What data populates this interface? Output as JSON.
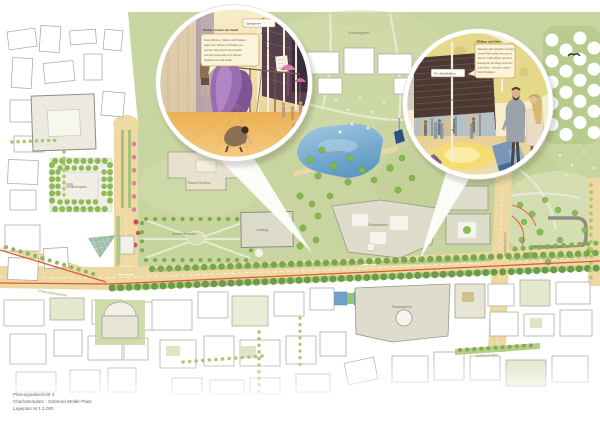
{
  "page": {
    "background": "#ffffff"
  },
  "title_block": {
    "line1": "Planungsabschnitt 4",
    "line2": "Charlottenplatz - Gebhard-Müller-Platz",
    "line3": "Lageplan M 1:1.000"
  },
  "map": {
    "palette": {
      "park_green": "#c8d5a0",
      "lawn_light": "#d8e0b8",
      "road_tan": "#ecd8a0",
      "water_blue": "#6fa3cc",
      "tram_red": "#dd5a3a",
      "tree_green": "#7fae4e",
      "building_grey": "#deddcb",
      "blossom_pink": "#df7fa2"
    },
    "labels": [
      {
        "id": "charlottenstrasse",
        "text": "Charlottenstraße"
      },
      {
        "id": "konrad-adenauer-west",
        "text": "Konrad-Adenauer-Straße"
      },
      {
        "id": "konrad-adenauer-ost",
        "text": "Konrad-Adenauer-Straße"
      },
      {
        "id": "schillerstrasse",
        "text": "Schillerstraße"
      },
      {
        "id": "urbanstrasse",
        "text": "Urbanstraße"
      },
      {
        "id": "landtag",
        "text": "Landtag"
      },
      {
        "id": "staatstheater",
        "text": "Staatstheater"
      },
      {
        "id": "staatsgalerie",
        "text": "Staatsgalerie"
      },
      {
        "id": "eckensee",
        "text": "Eckensee"
      },
      {
        "id": "akademiegarten",
        "text": "Akademiegarten"
      },
      {
        "id": "neues-schloss",
        "text": "Neues Schloss"
      },
      {
        "id": "karlsplatz",
        "text": "Karlsplatz"
      },
      {
        "id": "schlossgarten",
        "text": "Schlossgarten"
      }
    ]
  },
  "inset_playground": {
    "tag": "Spielgarten",
    "bubble": {
      "title": "Kinder erobern die Stadt",
      "lines": [
        "Kleine Bühnen, Wände und Podeste",
        "laden zum Klettern und Malen ein.",
        "Auf dem Weg durch das Quartier",
        "wird die Kulturmeile zum offenen",
        "Spielraum für alle Kinder."
      ]
    }
  },
  "inset_plaza": {
    "tag": "Der Stadtbalkon",
    "bubble": {
      "title": "Philipp und Marie",
      "lines": [
        "Zwischen den Arkaden und dem",
        "neuen Park treffen wir uns am",
        "Abend: Cafés öffnen sich zum",
        "Boulevard, die Wege sind kurz",
        "und sicher – ein ganz neues",
        "Stück Stuttgart."
      ]
    }
  }
}
